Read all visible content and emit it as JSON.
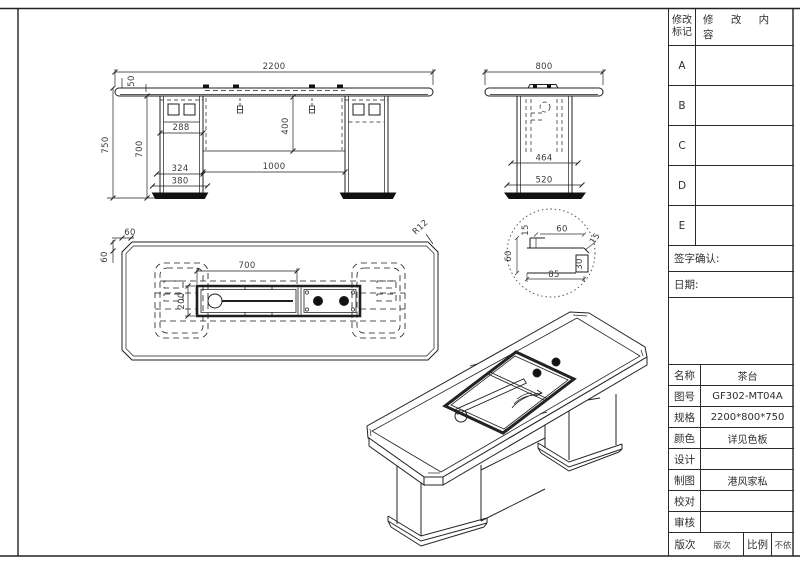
{
  "title_block": {
    "revision": {
      "header_col1_line1": "修改",
      "header_col1_line2": "标记",
      "header_col2": "修 改 内 容",
      "rows": [
        "A",
        "B",
        "C",
        "D",
        "E"
      ]
    },
    "signature_label": "签字确认:",
    "date_label": "日期:",
    "info_rows": [
      {
        "label": "名称",
        "value": "茶台"
      },
      {
        "label": "图号",
        "value": "GF302-MT04A"
      },
      {
        "label": "规格",
        "value": "2200*800*750"
      },
      {
        "label": "颜色",
        "value": "详见色板"
      },
      {
        "label": "设计",
        "value": ""
      },
      {
        "label": "制图",
        "value": "港风家私"
      },
      {
        "label": "校对",
        "value": ""
      },
      {
        "label": "审核",
        "value": ""
      }
    ],
    "bottom_row": {
      "version_label": "版次",
      "version_value": "版次",
      "scale_label": "比例",
      "scale_value": "不依"
    }
  },
  "views": {
    "front": {
      "dim_width": "2200",
      "dim_top_thickness": "50",
      "dim_total_height": "750",
      "dim_leg_height": "700",
      "dim_leg_width": "288",
      "dim_panel_height": "400",
      "dim_leg_lower": "324",
      "dim_base_width": "380",
      "dim_span": "1000"
    },
    "side": {
      "dim_width": "800",
      "dim_inner_width": "464",
      "dim_base_width": "520"
    },
    "plan": {
      "dim_edge_top": "60",
      "dim_edge_left": "60",
      "dim_box_length": "700",
      "dim_box_width": "200",
      "dim_corner_radius": "R12"
    },
    "detail": {
      "dim_step_top": "15",
      "dim_top_width": "60",
      "dim_lip": "15",
      "dim_height": "60",
      "dim_strip": "30",
      "dim_bottom_width": "85"
    }
  },
  "colors": {
    "line": "#1f1f1f",
    "dim_text": "#3c3c3c",
    "background": "#ffffff"
  }
}
